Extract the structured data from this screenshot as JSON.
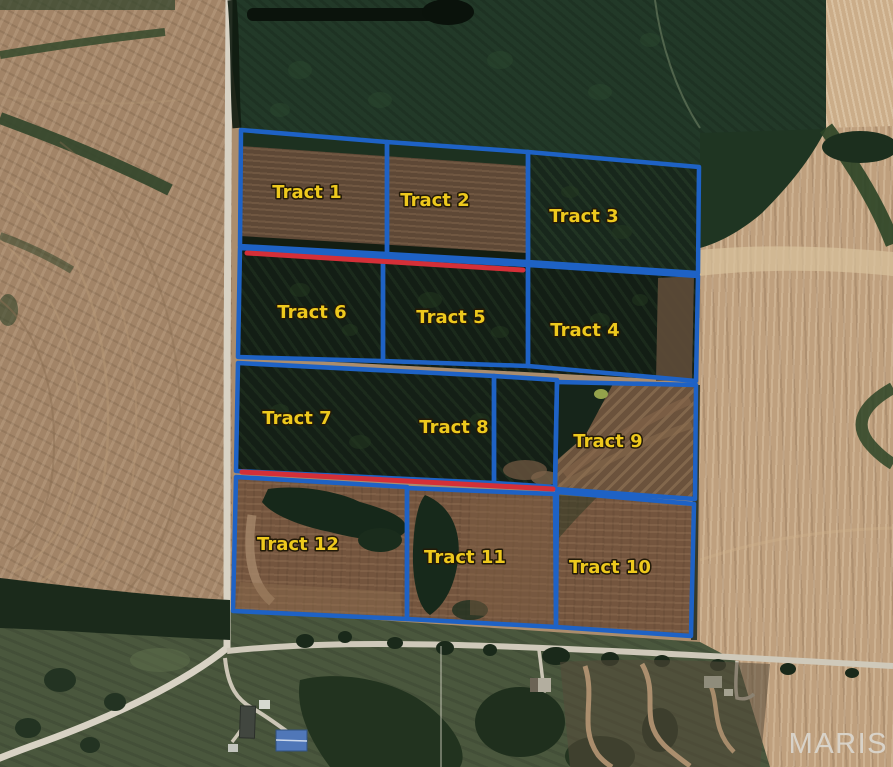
{
  "map": {
    "description": "Aerial photo of farmland divided into 12 auction tracts outlined in blue",
    "watermark": "MARIS",
    "colors": {
      "boundary_blue": "#1e62c5",
      "highlight_red": "#d42f38",
      "label_yellow": "#eec91d",
      "label_outline": "#231a08",
      "watermark_gray": "#dbd7cf"
    },
    "tracts": [
      {
        "label": "Tract 1",
        "label_x": 307,
        "label_y": 192,
        "polygon": "241,130 387,142 387,254 240,246"
      },
      {
        "label": "Tract 2",
        "label_x": 435,
        "label_y": 200,
        "polygon": "387,142 528,152 528,262 387,254"
      },
      {
        "label": "Tract 3",
        "label_x": 584,
        "label_y": 216,
        "polygon": "528,152 699,167 698,273 528,262"
      },
      {
        "label": "Tract 4",
        "label_x": 585,
        "label_y": 330,
        "polygon": "528,265 698,276 696,381 528,366"
      },
      {
        "label": "Tract 5",
        "label_x": 451,
        "label_y": 317,
        "polygon": "383,257 528,265 528,366 383,361"
      },
      {
        "label": "Tract 6",
        "label_x": 312,
        "label_y": 312,
        "polygon": "240,248 383,257 383,361 238,357"
      },
      {
        "label": "Tract 7",
        "label_x": 297,
        "label_y": 418,
        "polygon": "238,363 494,376 494,483 236,471"
      },
      {
        "label": "Tract 8",
        "label_x": 454,
        "label_y": 427,
        "polygon": "494,376 557,380 555,487 494,483"
      },
      {
        "label": "Tract 9",
        "label_x": 608,
        "label_y": 441,
        "polygon": "557,382 696,385 695,499 555,489"
      },
      {
        "label": "Tract 10",
        "label_x": 610,
        "label_y": 567,
        "polygon": "557,492 694,504 691,636 556,627"
      },
      {
        "label": "Tract 11",
        "label_x": 465,
        "label_y": 557,
        "polygon": "407,488 555,494 556,627 407,619"
      },
      {
        "label": "Tract 12",
        "label_x": 298,
        "label_y": 544,
        "polygon": "236,477 407,487 407,619 233,611"
      }
    ],
    "highlight_lines": [
      {
        "name": "red-line-top",
        "x1": 247,
        "y1": 253,
        "x2": 523,
        "y2": 270
      },
      {
        "name": "red-line-bottom",
        "x1": 242,
        "y1": 472,
        "x2": 553,
        "y2": 489
      }
    ]
  }
}
